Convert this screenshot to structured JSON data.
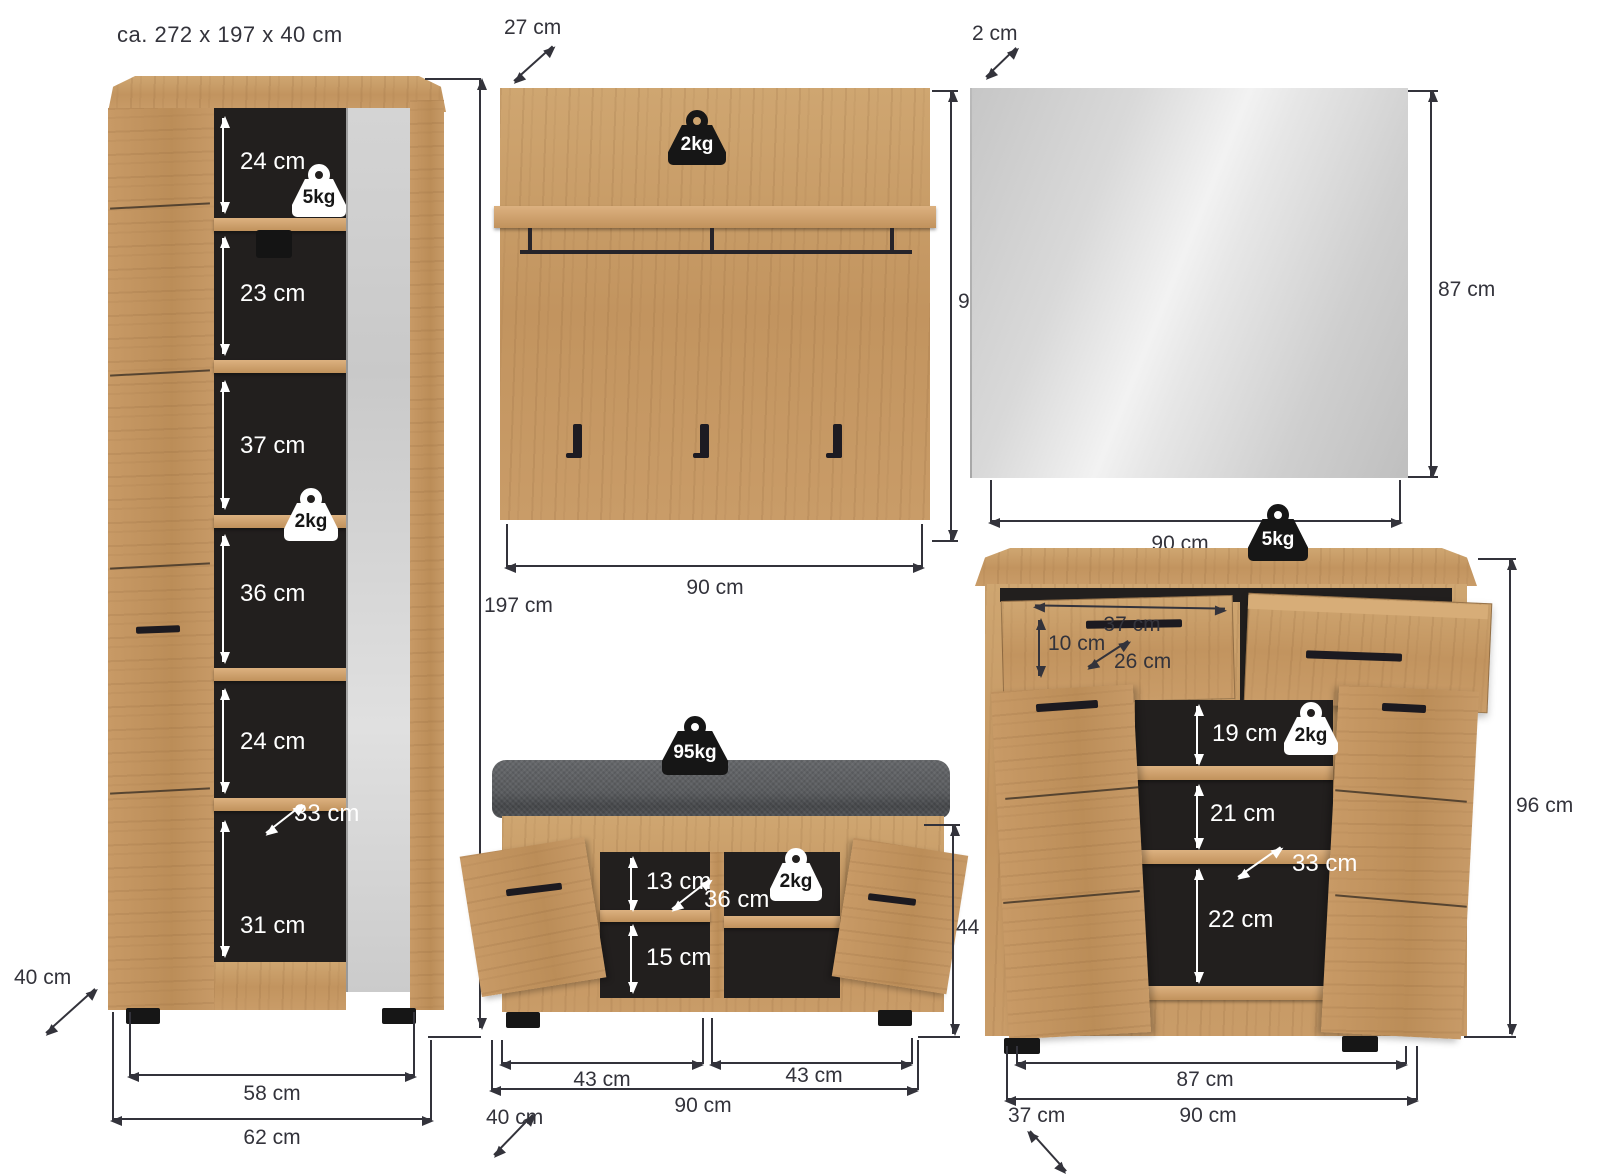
{
  "title": "ca. 272 x 197 x 40 cm",
  "units": "cm",
  "colors": {
    "wood": "#c79a67",
    "interior": "#221f1e",
    "mirror": "#dcdcdc",
    "cushion": "#5a5c5f",
    "dimension": "#33333b"
  },
  "wardrobe": {
    "shelves": [
      "24 cm",
      "23 cm",
      "37 cm",
      "36 cm",
      "24 cm",
      "31 cm"
    ],
    "inner_depth": "33 cm",
    "top_load": "5kg",
    "shelf_load": "2kg",
    "height": "197 cm",
    "depth": "40 cm",
    "feet_span": "58 cm",
    "width": "62 cm"
  },
  "coat_panel": {
    "depth": "27 cm",
    "shelf_load": "2kg",
    "height": "98 cm",
    "width": "90 cm"
  },
  "mirror": {
    "depth": "2 cm",
    "height": "87 cm",
    "width": "90 cm"
  },
  "bench": {
    "seat_load": "95kg",
    "shelf_load": "2kg",
    "upper_height": "13 cm",
    "inner_depth": "36 cm",
    "lower_height": "15 cm",
    "height": "44 cm",
    "left_door": "43 cm",
    "right_door": "43 cm",
    "width": "90 cm",
    "depth": "40 cm"
  },
  "chest": {
    "top_load": "5kg",
    "drawer_width": "37 cm",
    "drawer_height": "10 cm",
    "drawer_depth": "26 cm",
    "shelf1": "19 cm",
    "shelf_load": "2kg",
    "shelf2": "21 cm",
    "inner_depth": "33 cm",
    "shelf3": "22 cm",
    "height": "96 cm",
    "feet_span": "87 cm",
    "width": "90 cm",
    "depth": "37 cm"
  }
}
